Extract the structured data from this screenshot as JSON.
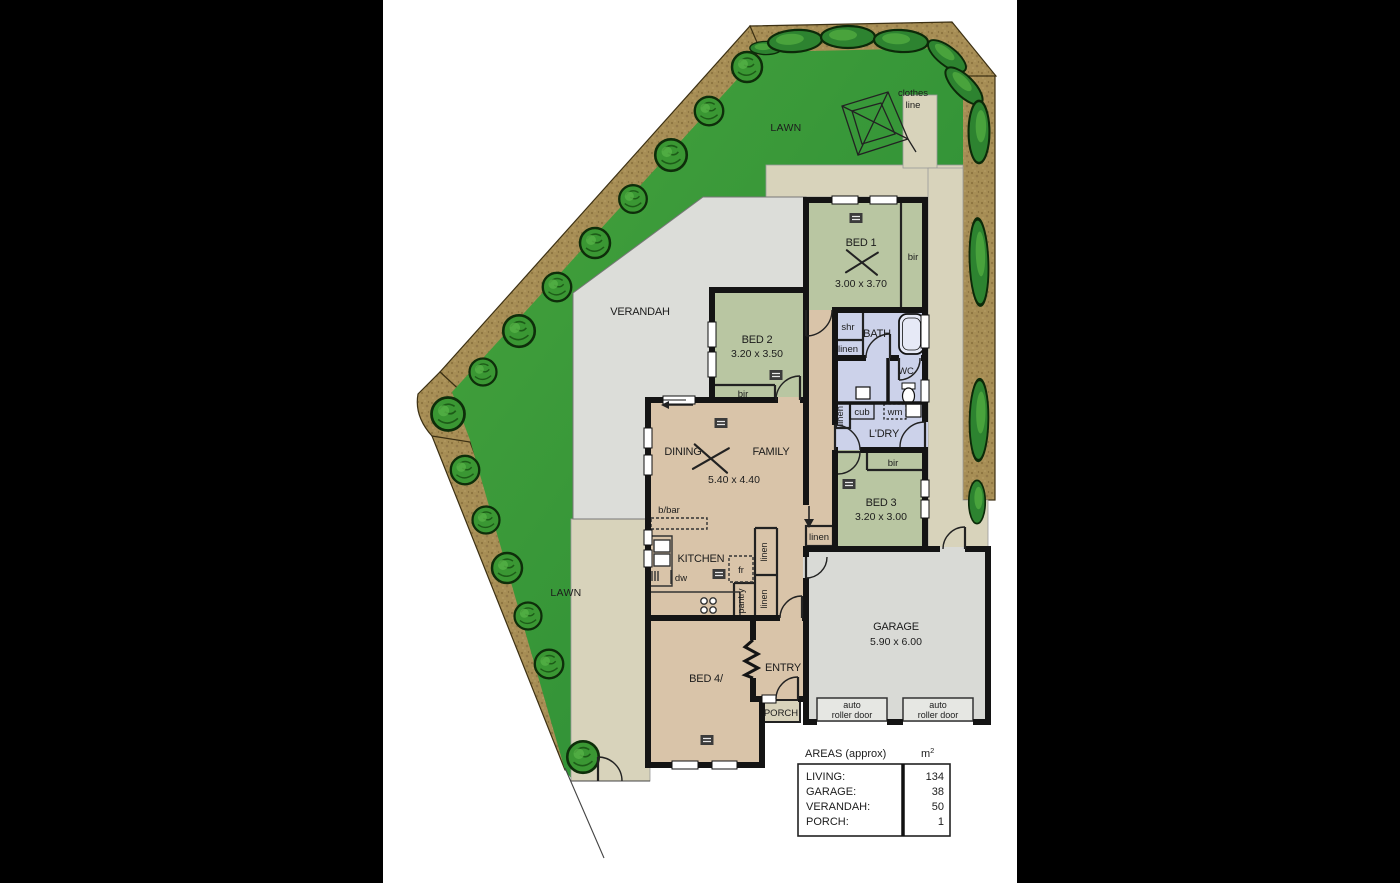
{
  "colors": {
    "background": "#000000",
    "paper": "#ffffff",
    "wall": "#141414",
    "bedroom_green": "#b9c6a2",
    "wet_area_lavender": "#ccd2ea",
    "living_tan": "#d9c4a9",
    "garage_gray": "#d9dad6",
    "verandah_gray": "#dcddd9",
    "path_beige": "#d8d3bb",
    "lawn_green": "#3a9c3e",
    "garden_bed_brown": "#a78e55",
    "tree_green": "#3a9733"
  },
  "site": {
    "lawn": "LAWN",
    "verandah": "VERANDAH",
    "clothes_line": [
      "clothes",
      "line"
    ]
  },
  "rooms": {
    "bed1": {
      "name": "BED 1",
      "dims": "3.00 x 3.70"
    },
    "bed2": {
      "name": "BED 2",
      "dims": "3.20 x 3.50"
    },
    "bed3": {
      "name": "BED 3",
      "dims": "3.20 x 3.00"
    },
    "bed4": {
      "name": "BED 4/"
    },
    "dining": "DINING",
    "family": "FAMILY",
    "dining_family_dims": "5.40 x 4.40",
    "kitchen": "KITCHEN",
    "bath": "BATH",
    "wc": "WC",
    "laundry": "L'DRY",
    "entry": "ENTRY",
    "porch": "PORCH",
    "garage": {
      "name": "GARAGE",
      "dims": "5.90 x 6.00",
      "roller_door": [
        "auto",
        "roller door"
      ]
    }
  },
  "fixtures": {
    "bir": "bir",
    "shr": "shr",
    "linen": "linen",
    "cub": "cub",
    "wm": "wm",
    "bbar": "b/bar",
    "fridge": "fr",
    "dishwasher": "dw",
    "pantry": "pantry"
  },
  "areas_table": {
    "title": "AREAS (approx)",
    "unit": "m",
    "unit_sup": "2",
    "rows": [
      [
        "LIVING:",
        "134"
      ],
      [
        "GARAGE:",
        "38"
      ],
      [
        "VERANDAH:",
        "50"
      ],
      [
        "PORCH:",
        "1"
      ]
    ]
  }
}
